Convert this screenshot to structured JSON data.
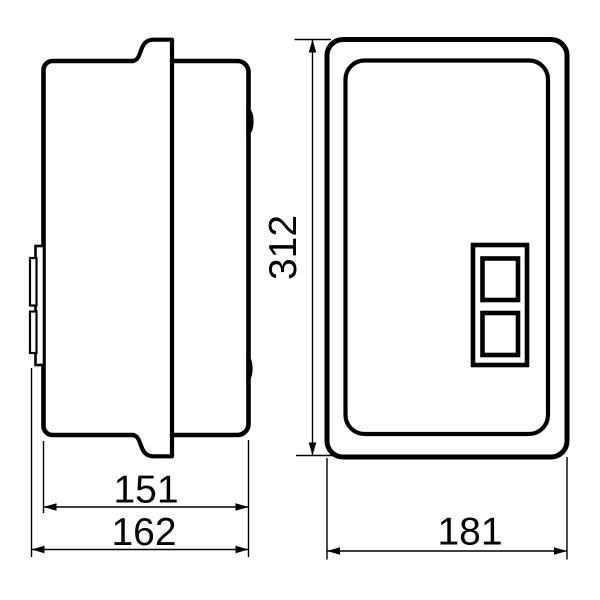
{
  "dimensions": {
    "side_body_width": "151",
    "side_overall_width": "162",
    "front_height": "312",
    "front_width": "181"
  },
  "colors": {
    "line": "#000000",
    "background": "#ffffff"
  }
}
